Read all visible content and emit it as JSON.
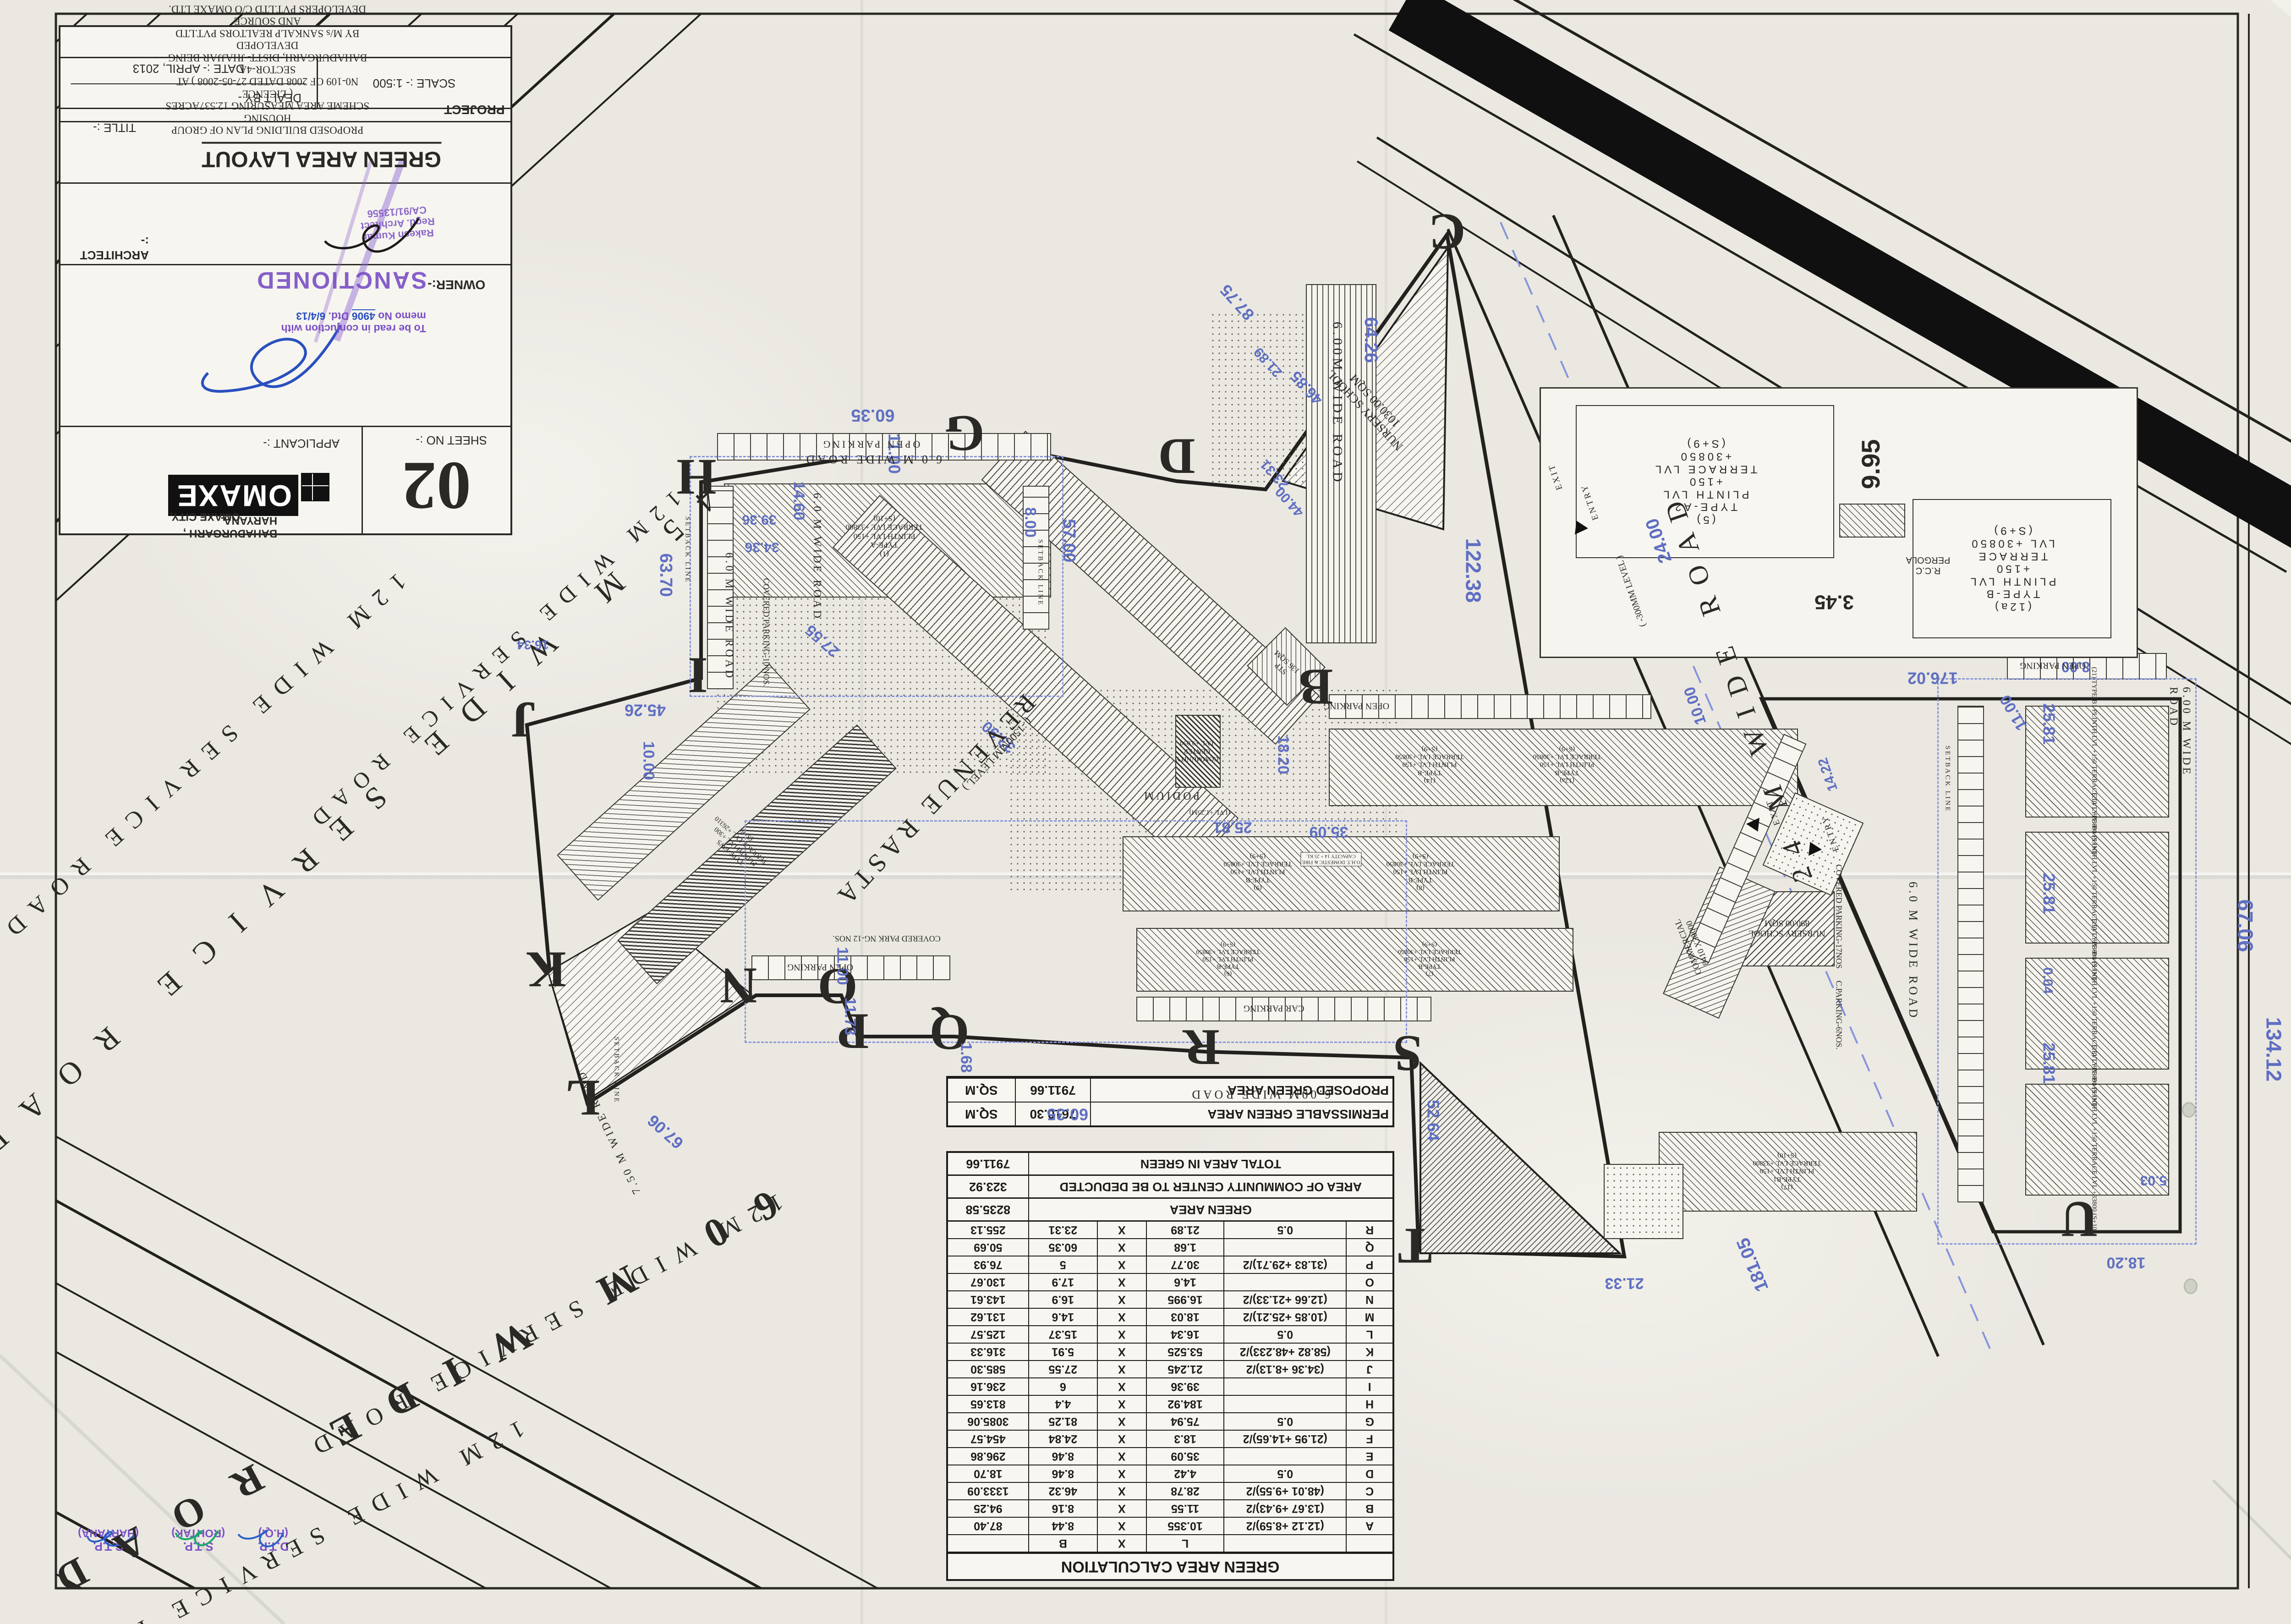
{
  "sheet": {
    "number": "02",
    "sheet_no_label": "SHEET NO :-"
  },
  "logo": {
    "name": "OMAXE",
    "city": "OMAXE CITY,",
    "place": "BAHADURGARH , HARYANA.",
    "applicant": "APPLICANT :-"
  },
  "title_block": {
    "owner_label": "OWNER:-",
    "architect_label": "ARCHITECT :-",
    "title_label": "TITLE :-",
    "title": "GREEN AREA LAYOUT",
    "scale": "SCALE :- 1:500",
    "dealt_by": "DEALT BY -",
    "date": "DATE :- APRIL, 2013",
    "project_label": "PROJECT",
    "project_lines": "PROPOSED BUILDING PLAN OF GROUP HOUSING\nSCHEME AREA MEASURING 12.537ACRES ( LICENCE\nN0-109 OF 2008 DATED 27-05-2008 ) AT SECTOR-4A\nBAHADURGARH, DISTT- JHAJJAR BEING DEVELOPED\nBY M/s SANKALP REALTORS PVT.LTD AND SOURCE\nDEVELOPERS PVT.LTD C/O OMAXE LTD."
  },
  "stamps": {
    "sanctioned": "SANCTIONED",
    "memo_line1": "To be read in conjuction with",
    "memo_line2a": "memo No ",
    "memo_no": "4906",
    "memo_line2b": " Dtd. ",
    "memo_date": "6/4/13",
    "architect_stamp": "Rakesh Kumar\nRegd. Architect\nCA/91/13556",
    "approvals": [
      {
        "t1": "C.T.P.",
        "t2": "(HARYANA)"
      },
      {
        "t1": "S.T.P.",
        "t2": "(ROHTAK)"
      },
      {
        "t1": "D.T.P.",
        "t2": "(H.Q.)"
      }
    ]
  },
  "table": {
    "title": "GREEN AREA CALCULATION",
    "header": [
      "",
      "",
      "L",
      "X",
      "B",
      ""
    ],
    "rows": [
      [
        "A",
        "(12.12 +8.59)/2",
        "10.355",
        "X",
        "8.44",
        "87.40"
      ],
      [
        "B",
        "(13.67 +9.43)/2",
        "11.55",
        "X",
        "8.16",
        "94.25"
      ],
      [
        "C",
        "(48.01 +9.55)/2",
        "28.78",
        "X",
        "46.32",
        "1333.09"
      ],
      [
        "D",
        "0.5",
        "4.42",
        "X",
        "8.46",
        "18.70"
      ],
      [
        "E",
        "",
        "35.09",
        "X",
        "8.46",
        "296.86"
      ],
      [
        "F",
        "(21.95 +14.65)/2",
        "18.3",
        "X",
        "24.84",
        "454.57"
      ],
      [
        "G",
        "0.5",
        "75.94",
        "X",
        "81.25",
        "3085.06"
      ],
      [
        "H",
        "",
        "184.92",
        "X",
        "4.4",
        "813.65"
      ],
      [
        "I",
        "",
        "39.36",
        "X",
        "6",
        "236.16"
      ],
      [
        "J",
        "(34.36 +8.13)/2",
        "21.245",
        "X",
        "27.55",
        "585.30"
      ],
      [
        "K",
        "(58.82 +48.233)/2",
        "53.525",
        "X",
        "5.91",
        "316.33"
      ],
      [
        "L",
        "0.5",
        "16.34",
        "X",
        "15.37",
        "125.57"
      ],
      [
        "M",
        "(10.85 +25.21)/2",
        "18.03",
        "X",
        "14.6",
        "131.62"
      ],
      [
        "N",
        "(12.66 +21.33)/2",
        "16.995",
        "X",
        "16.9",
        "143.61"
      ],
      [
        "O",
        "",
        "14.6",
        "X",
        "17.9",
        "130.67"
      ],
      [
        "P",
        "(31.83 +29.71)/2",
        "30.77",
        "X",
        "5",
        "76.93"
      ],
      [
        "Q",
        "",
        "1.68",
        "X",
        "60.35",
        "50.69"
      ],
      [
        "R",
        "0.5",
        "21.89",
        "X",
        "23.31",
        "255.13"
      ]
    ],
    "summary": [
      {
        "label": "GREEN AREA",
        "value": "8235.58"
      },
      {
        "label": "AREA OF COMMUNITY CENTER TO BE DEDUCTED",
        "value": "323.92"
      },
      {
        "label": "TOTAL AREA IN GREEN",
        "value": "7911.66"
      }
    ],
    "capacity": [
      {
        "label": "PERMISSABLE GREEN AREA",
        "value": "7610.30",
        "unit": "SQ.M"
      },
      {
        "label": "PROPOSED GREEN AREA",
        "value": "7911.66",
        "unit": "SQ.M"
      }
    ]
  },
  "roads": [
    "12M WIDE SERVICE ROAD",
    "45 M WIDE SERVICE ROAD",
    "12M WIDE SERVICE ROAD",
    "60 M WIDE ROAD",
    "12M WIDE SERVICE ROAD",
    "12M WIDE SERVICE ROAD",
    "24 M WIDE ROAD"
  ],
  "letters": [
    "B",
    "C",
    "D",
    "G",
    "H",
    "I",
    "J",
    "K",
    "L",
    "N",
    "O",
    "P",
    "Q",
    "R",
    "S",
    "T",
    "U"
  ],
  "dims": [
    "60.35",
    "63.70",
    "57.00",
    "45.26",
    "10.00",
    "8.00",
    "11.00",
    "64.26",
    "122.38",
    "46.85",
    "87.75",
    "21.89",
    "33.90",
    "27.55",
    "34.36",
    "39.36",
    "14.60",
    "25.81",
    "25.81",
    "25.81",
    "0.04",
    "67.06",
    "134.12",
    "176.02",
    "181.05",
    "25.81",
    "18.20",
    "35.09",
    "11.00",
    "11.73",
    "1.68",
    "60.35",
    "52.64",
    "21.33",
    "18.20",
    "67.06",
    "16.34",
    "24.00",
    "10.00",
    "14.22",
    "8.00",
    "11.00",
    "5.03",
    "23.31",
    "44.00"
  ],
  "labels": {
    "revenue": "REVENUE RASTA",
    "revenue_sub": "( -1500MM LEVEL )",
    "road6a": "6.00M WIDE ROAD",
    "road6b": "6.0 M WIDE ROAD",
    "road6c": "6.0 M WIDE ROAD",
    "road6d": "6.0 M WIDE ROAD",
    "road6e": "6.00M WIDE ROAD",
    "road6f": "6.0 M WIDE ROAD",
    "road6g": "6.00 M WIDE ROAD",
    "road75": "7.50 M WIDE ROAD",
    "openparking1": "OPEN PARKING",
    "openparking2": "OPEN PARKING",
    "openparking3": "OPEN PARKING",
    "openparking4": "OPEN PARKING",
    "carparking": "CAR PARKING",
    "coveredparking10": "COVERED PARKING-10 NOS.",
    "coveredpark12": "COVERED PARK NG-12 NOS.",
    "coveredparking17": "COVERED PARKING-17NOS",
    "cparking6": "C.PARKING-6NOS.",
    "school1": "NURSERY SCHOOL\n1030.00 SQM",
    "school2": "NURSERY SCHOOL\n890.00 SQM",
    "community": "COMMUNITY\nCENTER\nLVL +9.050",
    "podium": "PODIUM",
    "podium_sub": "(LVL +1.25M)",
    "commercial": "COMMERCIAL\n8410 X30000",
    "stp": "STP\n136 SQM",
    "typeA": "(1)\nTYPE-A\nPLINTH LVL +150\nTERRACE LVL +33800\n(S+10)",
    "typeB14": "(14)\nTYPE-B\nPLINTH LVL +150\nTERRACE LVL +30850\n(S+9)",
    "typeB12a": "(12a)\nTYPE-B\nPLINTH LVL +150\nTERRACE LVL +30850\n(S+9)",
    "typeB9": "(9)\nTYPE-B\nPLINTH LVL +150\nTERRACE LVL +30850\n(S+9)",
    "typeB8": "(8)\nTYPE-B\nPLINTH LVL +150\nTERRACE LVL +30850\n(S+9)",
    "typeB6": "(6)\nTYPE-B\nPLINTH LVL +150\nTERRACE LVL +30850\n(S+9)",
    "typeB7": "(7)\nTYPE-B\nPLINTH LVL +150\nTERRACE LVL +30850\n(S+9)",
    "typeB17": "(17)\nTYPE-B1\nPLINTH LVL +150\nTERRACE LVL +33800\n(S+10)",
    "typeB121": "(21) TYPE-B1  PLINTH LVL +150  TERRACE LVL +33800  (S+10)",
    "typeB120": "(20) TYPE-B1  PLINTH LVL +150  TERRACE LVL +33800  (S+10)",
    "typeB119": "(19) TYPE-B1  PLINTH LVL +150  TERRACE LVL +33800  (S+10)",
    "typeB118": "(18) TYPE-B1  PLINTH LVL +150  TERRACE LVL +33800  (S+10)",
    "typeEWS": "TYPE-EWS\nPLINTH LVL +300\nTERRACE LVL +26310\n(S+8)",
    "entry1": "ENTRY",
    "exit1": "EXIT",
    "entry2": "ENTRY",
    "exit2": "EXIT",
    "setback1": "SETBACK LINE",
    "setback2": "SETBACK LINE",
    "setback3": "SETBACK LINE",
    "setback4": "SETBACK LINE",
    "oht": "O.H.T. DOMESTIC & FIRE\nCAPACITY 14 + 25 KL",
    "level24": "( -300MM LEVEL )"
  },
  "inset": {
    "a": "(5)\nTYPE-A2\nPLINTH LVL +150\nTERRACE LVL +30850\n(S+9)",
    "b": "(12a)\nTYPE-B\nPLINTH LVL +150\nTERRACE LVL +30850\n(S+9)",
    "pergola": "R.C.C\nPERGOLA",
    "d1": "9.95",
    "d2": "3.45"
  }
}
